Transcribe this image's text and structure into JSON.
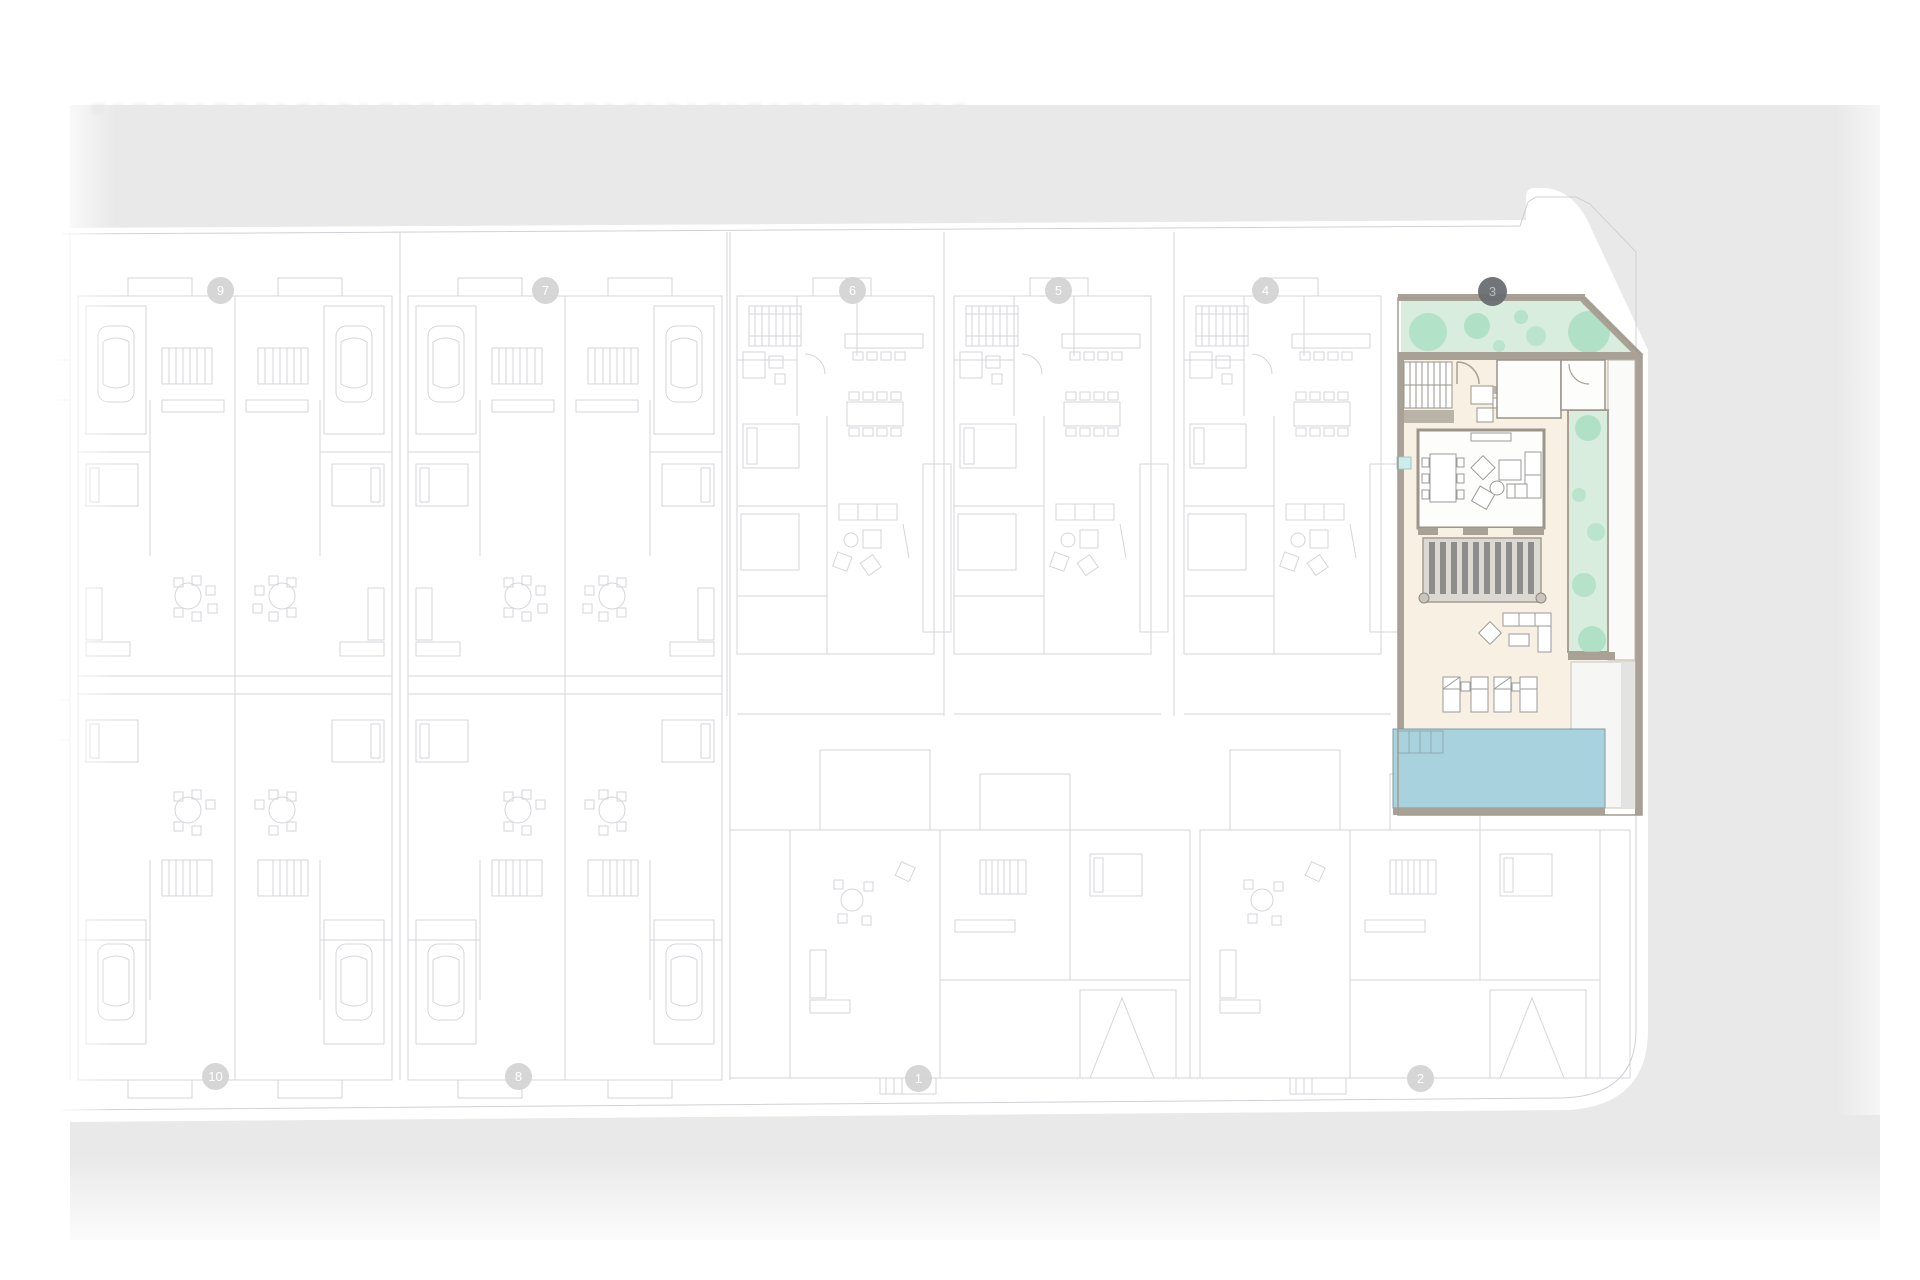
{
  "plan": {
    "highlighted_unit": "3",
    "markers": [
      {
        "label": "9",
        "active": false
      },
      {
        "label": "7",
        "active": false
      },
      {
        "label": "6",
        "active": false
      },
      {
        "label": "5",
        "active": false
      },
      {
        "label": "4",
        "active": false
      },
      {
        "label": "3",
        "active": true
      },
      {
        "label": "10",
        "active": false
      },
      {
        "label": "8",
        "active": false
      },
      {
        "label": "1",
        "active": false
      },
      {
        "label": "2",
        "active": false
      }
    ]
  },
  "colors": {
    "street": "#e9e9e9",
    "linework": "#d6d6db",
    "plot_line": "#d0d0d6",
    "garden": "#d8edde",
    "tree": "#a6ddc0",
    "wall": "#a9a195",
    "floor": "#f8f0e3",
    "room_white": "#fdfdfc",
    "pergola_bg": "#dcd9d3",
    "pergola_slat": "#8d8e8b",
    "pool": "#a7d2de",
    "pool_edge": "#7f9ba5",
    "accent_cyan": "#ccecee",
    "furniture_line": "#9a9a98",
    "marker_bg": "#d4d4d4",
    "marker_text": "#ffffff",
    "marker_active_bg": "#6a6e72",
    "marker_active_text": "#b4beb7"
  }
}
